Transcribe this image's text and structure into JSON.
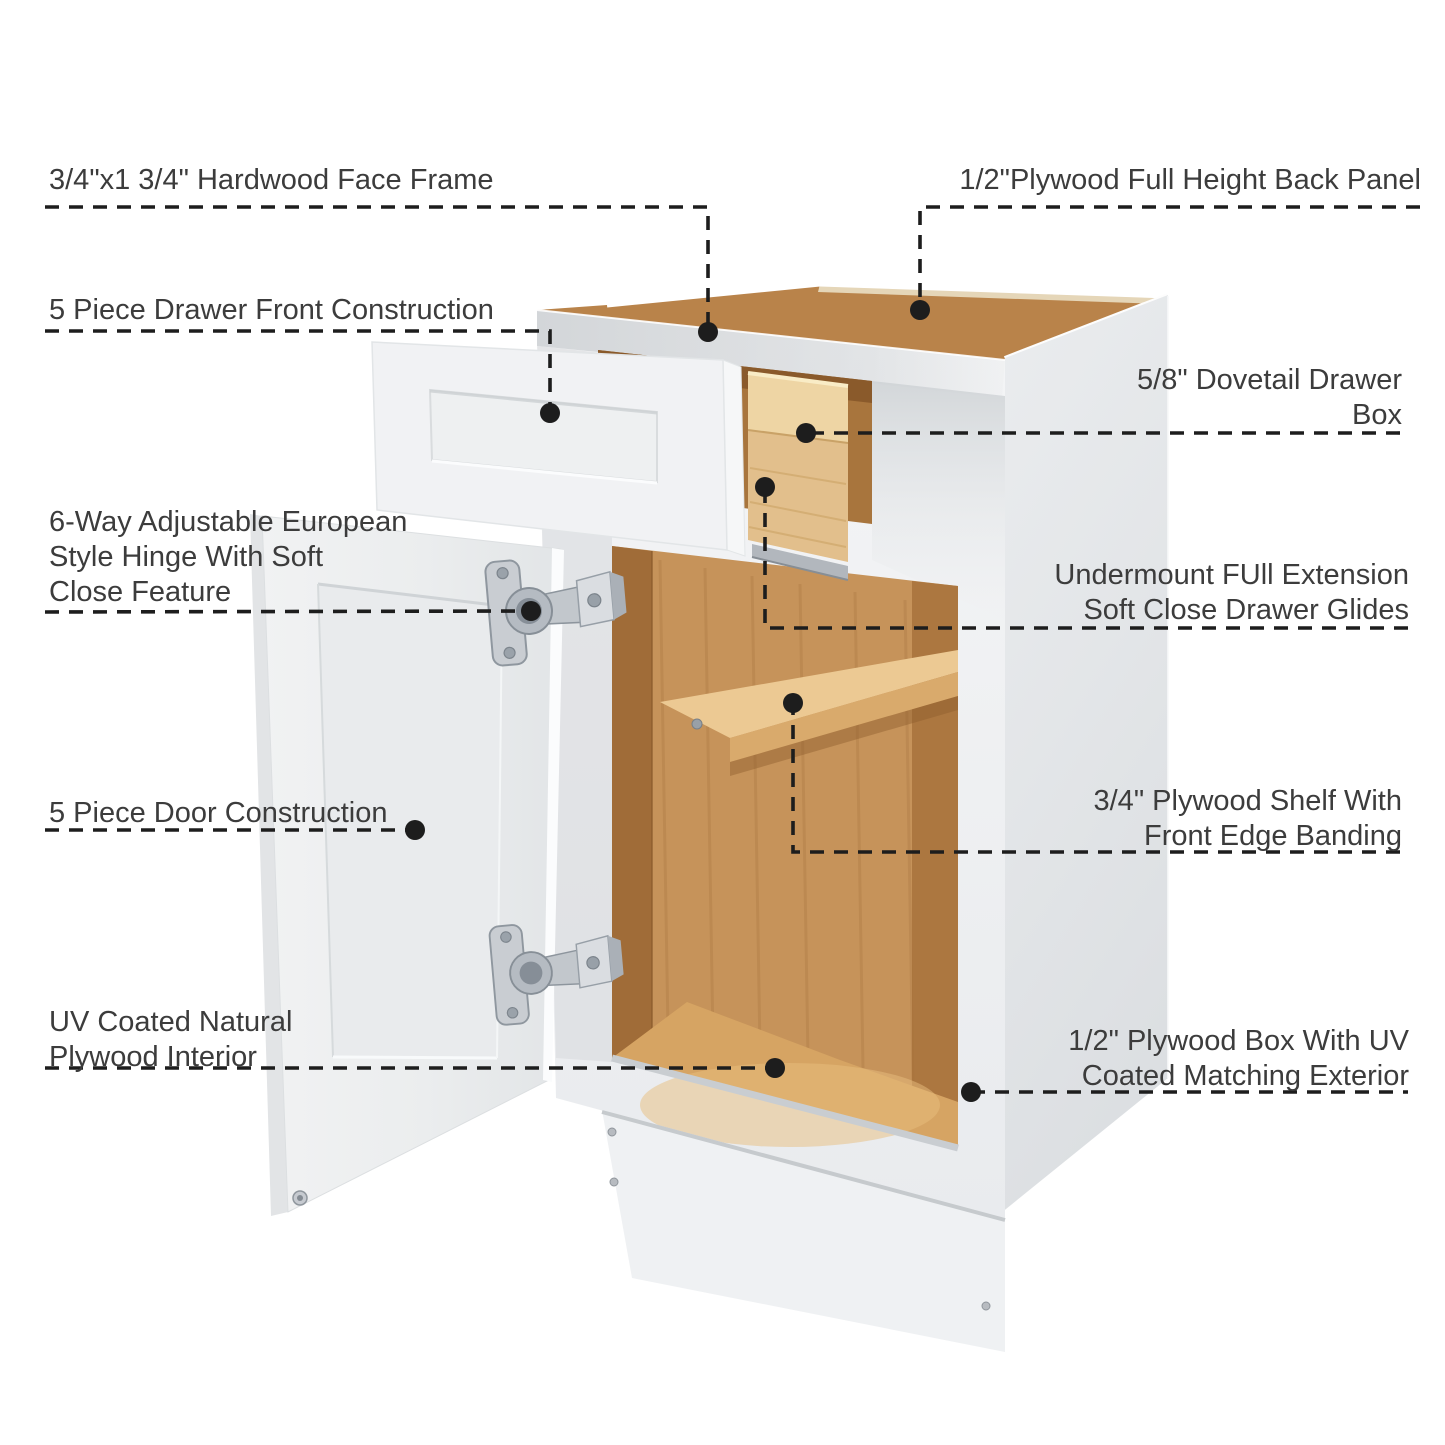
{
  "page": {
    "kind": "product-feature-diagram",
    "subject": "white shaker base cabinet with open drawer and door",
    "background": "#ffffff"
  },
  "colors": {
    "label_text": "#3c3c3c",
    "leader_line": "#1d1d1d",
    "cabinet_white": "#f1f2f4",
    "panel_gray": "#e4e7e9",
    "top_wood": "#b9834a",
    "interior_wood": "#c6935a",
    "floor_wood": "#d6a463",
    "shelf_wood": "#ecc993",
    "drawer_box_wood": "#e2bf8c",
    "hardware_silver": "#b5bbc2"
  },
  "callouts": {
    "left": [
      {
        "id": "hardwood-face-frame",
        "text": "3/4\"x1 3/4\" Hardwood Face Frame"
      },
      {
        "id": "drawer-front-construction",
        "text": "5 Piece Drawer Front Construction"
      },
      {
        "id": "european-hinge",
        "text": "6-Way Adjustable European\nStyle Hinge With Soft\nClose Feature"
      },
      {
        "id": "door-construction",
        "text": "5 Piece Door Construction"
      },
      {
        "id": "plywood-interior",
        "text": "UV Coated Natural\nPlywood Interior"
      }
    ],
    "right": [
      {
        "id": "back-panel",
        "text": "1/2\"Plywood Full Height Back Panel"
      },
      {
        "id": "dovetail-drawer-box",
        "text": "5/8\" Dovetail Drawer\nBox"
      },
      {
        "id": "drawer-glides",
        "text": "Undermount FUll Extension\nSoft Close Drawer Glides"
      },
      {
        "id": "plywood-shelf",
        "text": "3/4\"  Plywood Shelf With\nFront Edge Banding"
      },
      {
        "id": "plywood-box",
        "text": "1/2\" Plywood Box With UV\nCoated Matching Exterior"
      }
    ]
  }
}
